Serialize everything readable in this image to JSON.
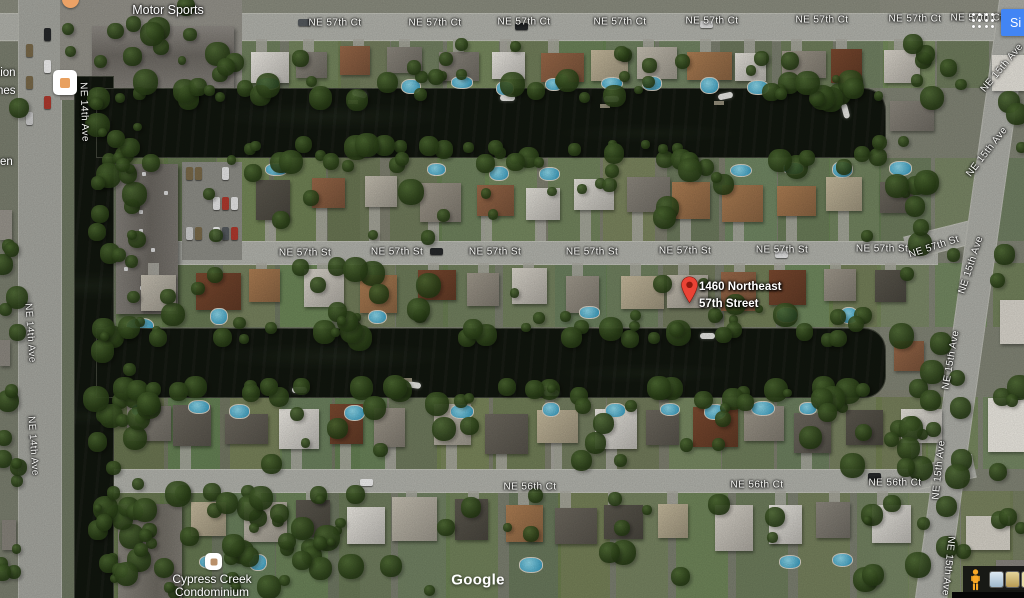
{
  "page": {
    "watermark": "Google",
    "signin_label": "Si"
  },
  "marker": {
    "title_line1": "1460 Northeast",
    "title_line2": "57th Street"
  },
  "poi": {
    "motor_sports": "Motor Sports",
    "cypress_line1": "Cypress Creek",
    "cypress_line2": "Condominium",
    "fragment_top_1": "tion",
    "fragment_top_2": "nes",
    "fragment_mid": "en"
  },
  "street_labels": [
    {
      "text": "NE 57th Ct",
      "x": 335,
      "y": 23
    },
    {
      "text": "NE 57th Ct",
      "x": 435,
      "y": 23
    },
    {
      "text": "NE 57th Ct",
      "x": 524,
      "y": 22
    },
    {
      "text": "NE 57th Ct",
      "x": 620,
      "y": 22
    },
    {
      "text": "NE 57th Ct",
      "x": 712,
      "y": 21
    },
    {
      "text": "NE 57th Ct",
      "x": 822,
      "y": 20
    },
    {
      "text": "NE 57th Ct",
      "x": 915,
      "y": 19
    },
    {
      "text": "NE 57th Ct",
      "x": 977,
      "y": 18
    },
    {
      "text": "NE 57th St",
      "x": 305,
      "y": 253
    },
    {
      "text": "NE 57th St",
      "x": 397,
      "y": 252
    },
    {
      "text": "NE 57th St",
      "x": 495,
      "y": 252
    },
    {
      "text": "NE 57th St",
      "x": 592,
      "y": 252
    },
    {
      "text": "NE 57th St",
      "x": 685,
      "y": 251
    },
    {
      "text": "NE 57th St",
      "x": 782,
      "y": 250
    },
    {
      "text": "NE 57th St",
      "x": 882,
      "y": 249
    },
    {
      "text": "NE 57th St",
      "x": 934,
      "y": 247,
      "rot": -18
    },
    {
      "text": "NE 56th Ct",
      "x": 530,
      "y": 487
    },
    {
      "text": "NE 56th Ct",
      "x": 757,
      "y": 485
    },
    {
      "text": "NE 56th Ct",
      "x": 895,
      "y": 483
    },
    {
      "text": "NE 14th Ave",
      "x": 84,
      "y": 112,
      "rot": 88
    },
    {
      "text": "NE 14th Ave",
      "x": 30,
      "y": 333,
      "rot": 86
    },
    {
      "text": "NE 14th Ave",
      "x": 33,
      "y": 446,
      "rot": 86
    },
    {
      "text": "NE 15th Ave",
      "x": 1002,
      "y": 68,
      "rot": -50
    },
    {
      "text": "NE 15th Ave",
      "x": 987,
      "y": 152,
      "rot": -52
    },
    {
      "text": "NE 15th Ave",
      "x": 971,
      "y": 265,
      "rot": -72
    },
    {
      "text": "NE 15th Ave",
      "x": 951,
      "y": 360,
      "rot": -80
    },
    {
      "text": "NE 15th Ave",
      "x": 939,
      "y": 470,
      "rot": -84
    },
    {
      "text": "NE 15th Ave",
      "x": 948,
      "y": 566,
      "rot": 96
    }
  ],
  "colors": {
    "marker_red": "#ea4335",
    "marker_red_dark": "#8c1a0f",
    "signin_blue": "#4285f4",
    "pegman_orange": "#f9a825",
    "water_dark": "#11160e",
    "road_gray": "#b4b5ae",
    "label_white": "#ffffff"
  }
}
